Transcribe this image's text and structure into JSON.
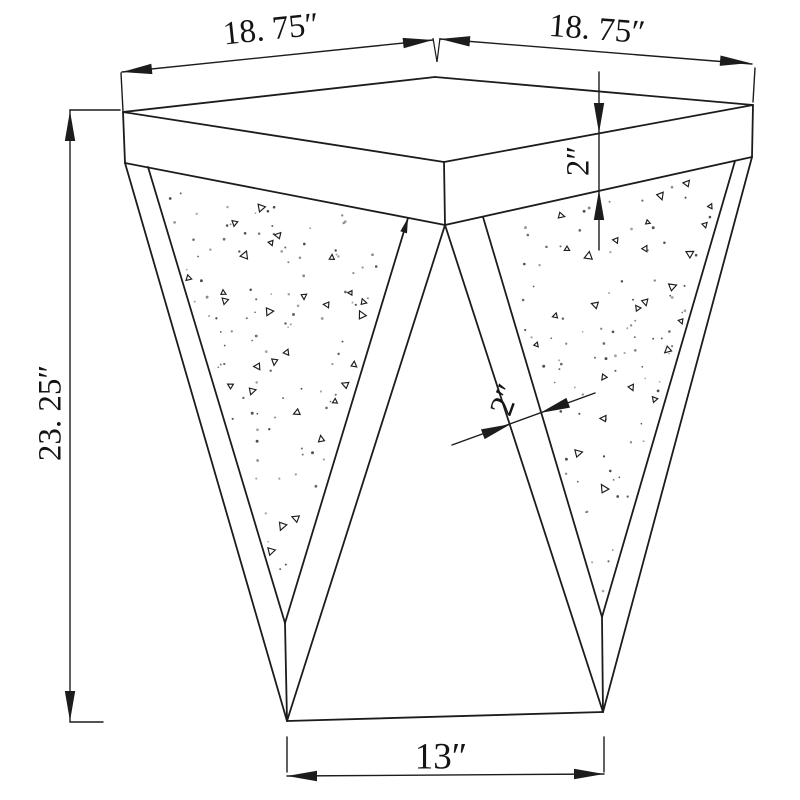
{
  "meta": {
    "title": "Technical dimension drawing of triangular side table"
  },
  "colors": {
    "background": "#ffffff",
    "line": "#1c1c1c",
    "text": "#141414",
    "dot_shades": [
      "#3c3c3c",
      "#5a5a5a",
      "#7d7d7d",
      "#999999"
    ]
  },
  "labels": {
    "top_left_width": "18. 75″",
    "top_right_width": "18. 75″",
    "overall_height": "23. 25″",
    "top_thickness": "2″",
    "frame_width": "2″",
    "base_width": "13″"
  },
  "drawing": {
    "outline_width": 1.8,
    "dim_width": 1.4,
    "outline": [
      {
        "n": "tabletop-back-left-edge",
        "p": [
          435,
          77,
          123,
          112
        ]
      },
      {
        "n": "tabletop-back-right-edge",
        "p": [
          435,
          77,
          753,
          105
        ]
      },
      {
        "n": "tabletop-front-left-edge",
        "p": [
          123,
          112,
          444,
          162
        ]
      },
      {
        "n": "tabletop-front-right-edge",
        "p": [
          444,
          162,
          753,
          105
        ]
      },
      {
        "n": "apron-left-corner-edge",
        "p": [
          123,
          112,
          125,
          163
        ]
      },
      {
        "n": "apron-front-corner-edge",
        "p": [
          444,
          162,
          445,
          225
        ]
      },
      {
        "n": "apron-right-corner-edge",
        "p": [
          753,
          105,
          752,
          157
        ]
      },
      {
        "n": "apron-bottom-left-edge",
        "p": [
          125,
          163,
          445,
          225
        ]
      },
      {
        "n": "apron-bottom-right-edge",
        "p": [
          445,
          225,
          752,
          157
        ]
      },
      {
        "n": "left-leg-outer-left-edge",
        "p": [
          125,
          163,
          287,
          721
        ]
      },
      {
        "n": "left-leg-outer-right-edge",
        "p": [
          445,
          225,
          287,
          721
        ]
      },
      {
        "n": "right-leg-outer-left-edge",
        "p": [
          445,
          225,
          603,
          712
        ]
      },
      {
        "n": "right-leg-outer-right-edge",
        "p": [
          752,
          157,
          603,
          712
        ]
      },
      {
        "n": "left-panel-left-edge",
        "p": [
          148,
          167,
          285,
          623
        ]
      },
      {
        "n": "left-panel-right-edge",
        "p": [
          408,
          218,
          285,
          623
        ]
      },
      {
        "n": "right-panel-left-edge",
        "p": [
          483,
          217,
          602,
          617
        ]
      },
      {
        "n": "right-panel-right-edge",
        "p": [
          735,
          161,
          602,
          617
        ]
      },
      {
        "n": "left-leg-tip-edge",
        "p": [
          285,
          623,
          287,
          721
        ]
      },
      {
        "n": "right-leg-tip-edge",
        "p": [
          602,
          617,
          603,
          712
        ]
      },
      {
        "n": "base-front-edge",
        "p": [
          287,
          721,
          603,
          712
        ]
      }
    ],
    "dims": [
      {
        "n": "height-dim-line",
        "p": [
          70,
          110,
          70,
          722
        ]
      },
      {
        "n": "height-top-tick",
        "p": [
          70,
          110,
          120,
          110
        ]
      },
      {
        "n": "height-bottom-tick",
        "p": [
          70,
          722,
          103,
          722
        ]
      },
      {
        "n": "left-corner-extension",
        "p": [
          121,
          73,
          123,
          111
        ]
      },
      {
        "n": "top-left-dim-line",
        "p": [
          122,
          72,
          433,
          40
        ]
      },
      {
        "n": "top-right-dim-line",
        "p": [
          440,
          39,
          752,
          64
        ]
      },
      {
        "n": "right-corner-extension",
        "p": [
          755,
          68,
          753,
          102
        ]
      },
      {
        "n": "top-thickness-dim-line",
        "p": [
          599,
          72,
          599,
          250
        ]
      },
      {
        "n": "frame-dim-line",
        "p": [
          452,
          445,
          595,
          393
        ]
      },
      {
        "n": "base-left-extension",
        "p": [
          287,
          737,
          287,
          772
        ]
      },
      {
        "n": "base-right-extension",
        "p": [
          604,
          737,
          604,
          772
        ]
      },
      {
        "n": "base-dim-line",
        "p": [
          287,
          776,
          604,
          774
        ]
      }
    ],
    "vticks": [
      {
        "n": "center-extension-vtick",
        "tops": [
          [
            433,
            38
          ],
          [
            440,
            38
          ]
        ],
        "apex": [
          437,
          62
        ]
      }
    ],
    "arrows": [
      {
        "n": "height-top-arrow",
        "tip": [
          70,
          111
        ],
        "ang": -90
      },
      {
        "n": "height-bottom-arrow",
        "tip": [
          70,
          721
        ],
        "ang": 90
      },
      {
        "n": "top-left-dim-left-arrow",
        "tip": [
          122,
          72
        ],
        "ang": 174.1
      },
      {
        "n": "top-left-dim-right-arrow",
        "tip": [
          433,
          40
        ],
        "ang": -5.9
      },
      {
        "n": "top-right-dim-left-arrow",
        "tip": [
          440,
          39
        ],
        "ang": 184.4
      },
      {
        "n": "top-right-dim-right-arrow",
        "tip": [
          750,
          63
        ],
        "ang": 4.4
      },
      {
        "n": "thickness-down-arrow",
        "tip": [
          599,
          133
        ],
        "ang": 90
      },
      {
        "n": "thickness-up-arrow",
        "tip": [
          599,
          190
        ],
        "ang": -90
      },
      {
        "n": "frame-dim-left-arrow",
        "tip": [
          511,
          424
        ],
        "ang": -20
      },
      {
        "n": "frame-dim-right-arrow",
        "tip": [
          540,
          413
        ],
        "ang": 160
      },
      {
        "n": "base-dim-left-arrow",
        "tip": [
          287,
          776
        ],
        "ang": 180
      },
      {
        "n": "base-dim-right-arrow",
        "tip": [
          604,
          774
        ],
        "ang": 0
      },
      {
        "n": "panel-edge-arrow",
        "tip": [
          408,
          218
        ],
        "ang": -73,
        "len": 15,
        "hw": 3.5
      }
    ],
    "arrow_default": {
      "len": 30,
      "hw": 5.2
    },
    "panels": [
      {
        "n": "left-leg-panel",
        "points": [
          [
            148,
            167
          ],
          [
            408,
            218
          ],
          [
            285,
            623
          ]
        ]
      },
      {
        "n": "right-leg-panel",
        "points": [
          [
            483,
            217
          ],
          [
            735,
            161
          ],
          [
            602,
            617
          ]
        ]
      }
    ]
  },
  "texture": {
    "seed": 1377,
    "triangles_per_panel": [
      28,
      25
    ],
    "dots_per_panel": [
      100,
      88
    ],
    "triangle_radius": [
      2.6,
      4.8
    ],
    "triangle_stroke": 1.15,
    "dot_radius": [
      0.8,
      1.5
    ],
    "inset": 0.93
  }
}
